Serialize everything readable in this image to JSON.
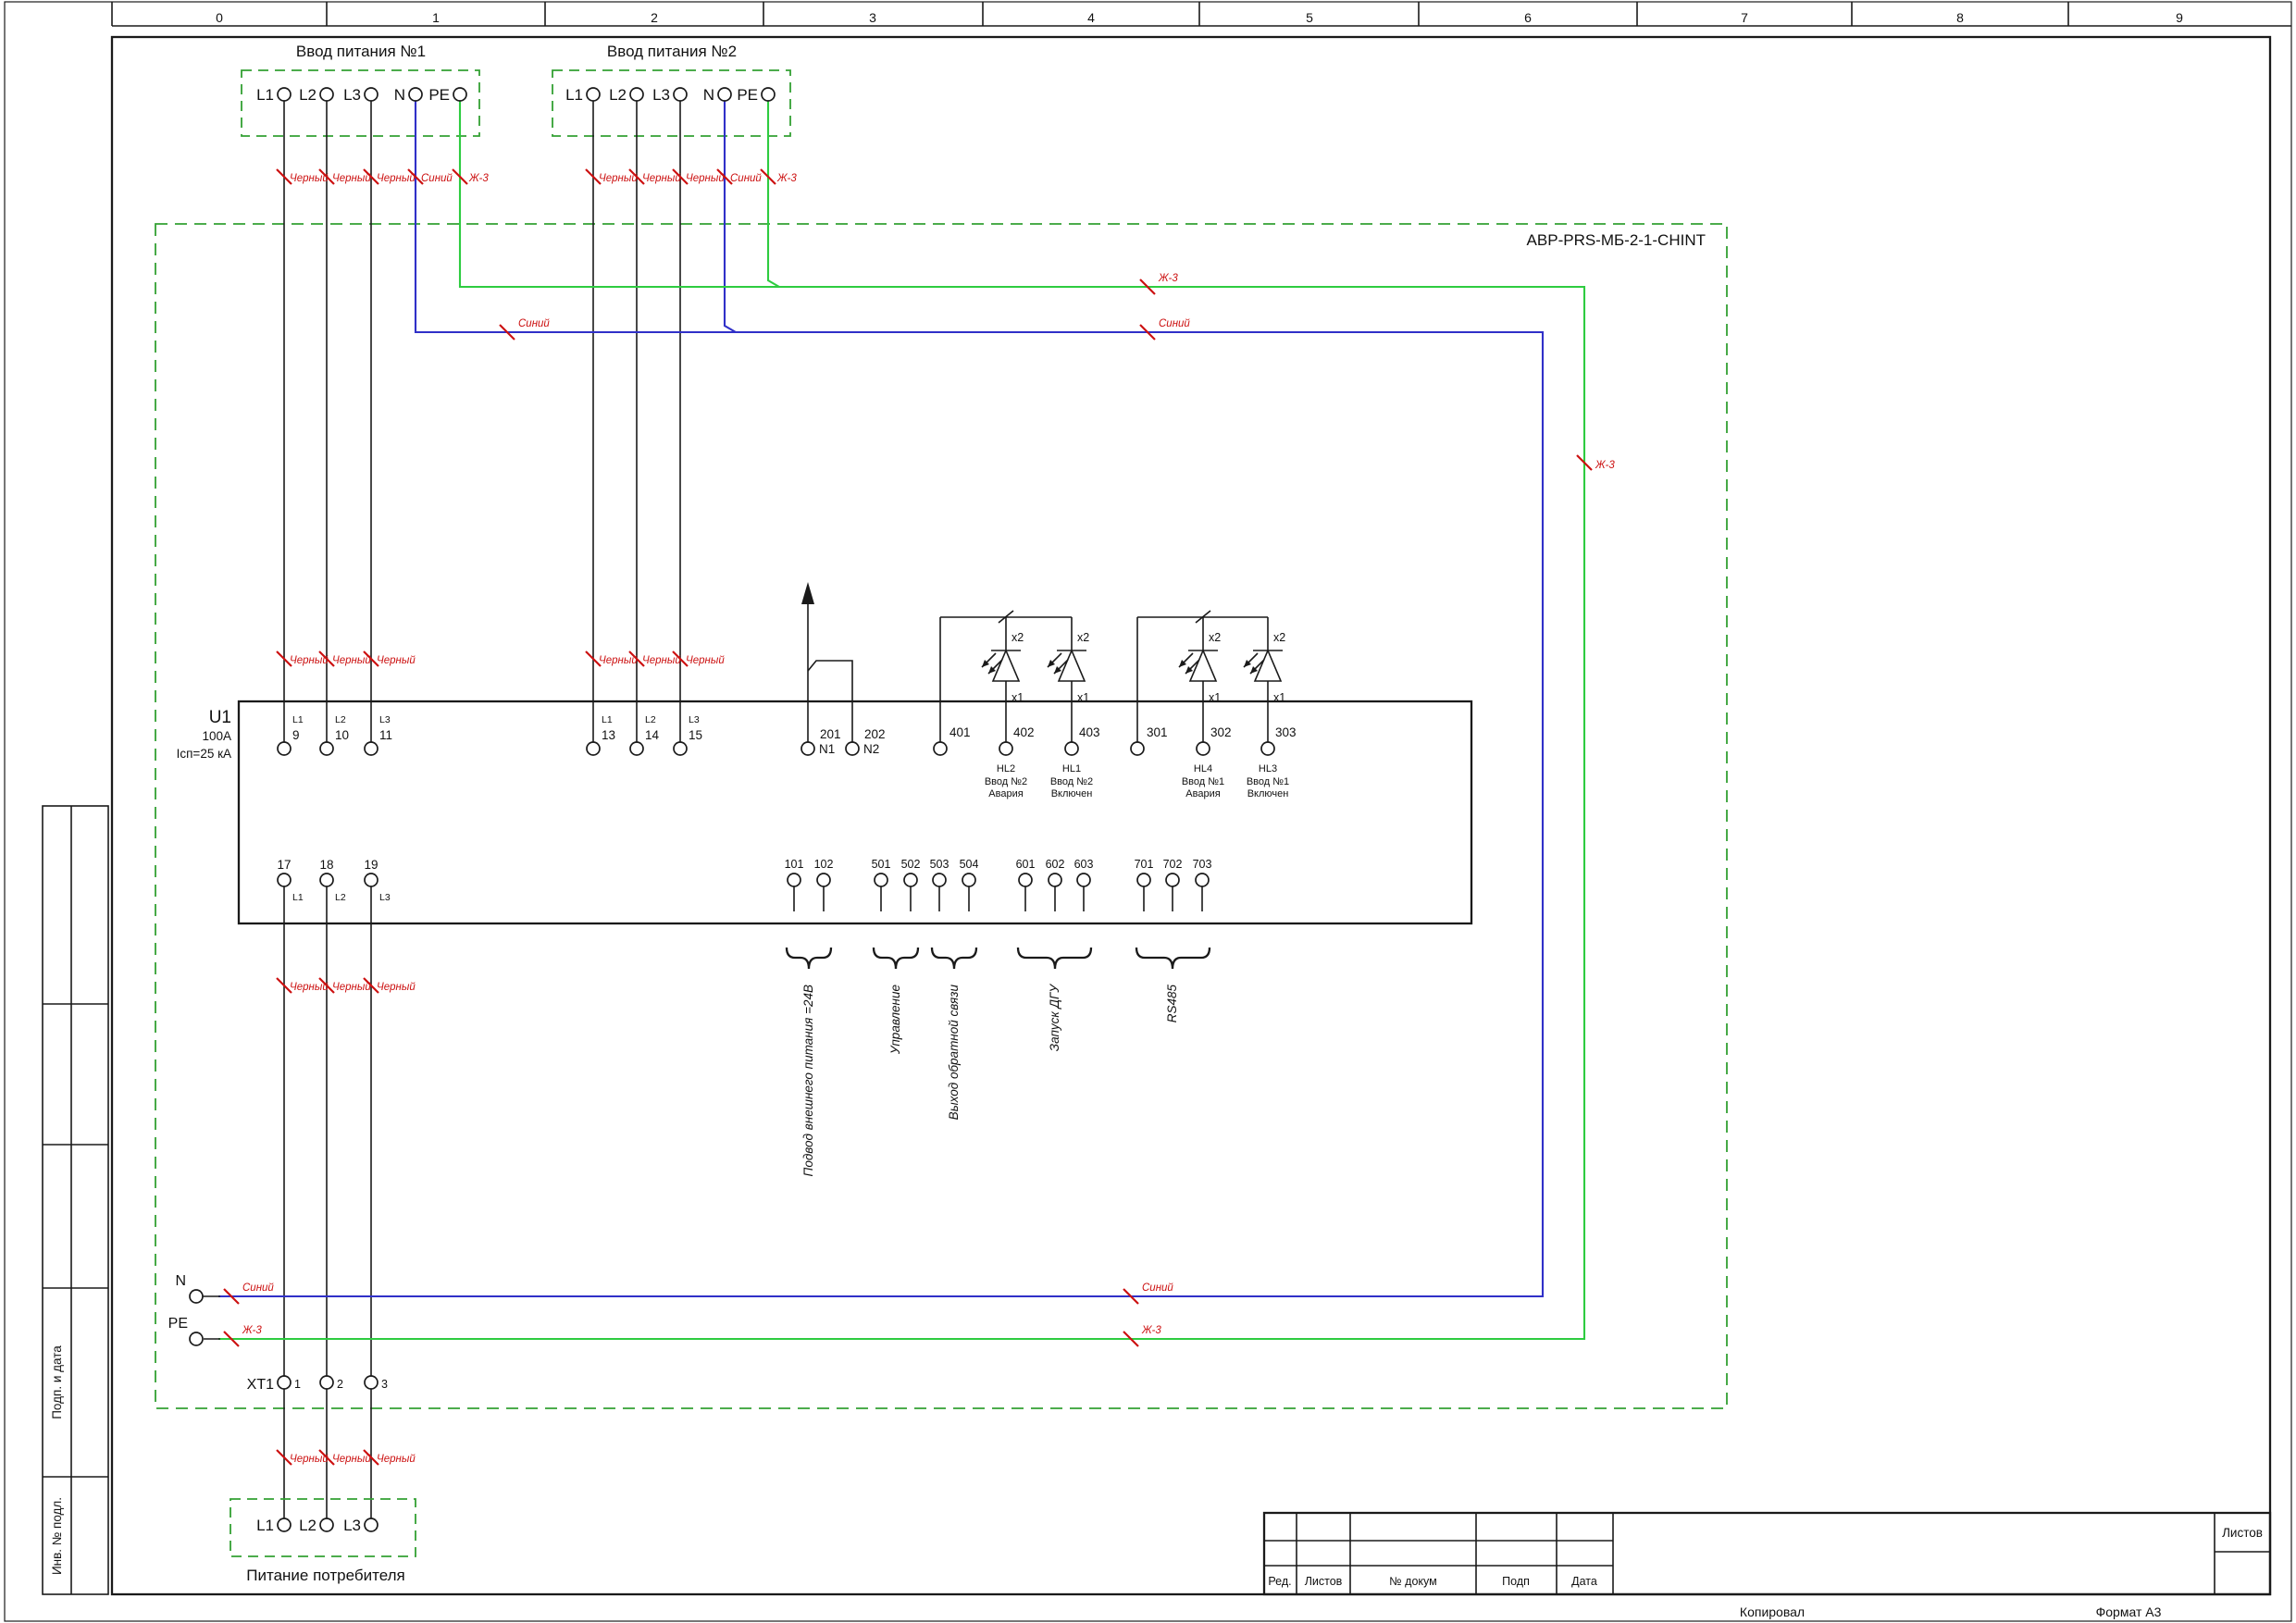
{
  "ruler": [
    "0",
    "1",
    "2",
    "3",
    "4",
    "5",
    "6",
    "7",
    "8",
    "9"
  ],
  "colors": {
    "wire_black": "#1a1a1a",
    "wire_blue": "#3030c8",
    "wire_green": "#2ecc40",
    "dashed_box_green": "#33a033",
    "wire_label_red": "#cc1111"
  },
  "labels": {
    "input1_title": "Ввод питания №1",
    "input2_title": "Ввод питания №2",
    "abp_box": "АВР-PRS-МБ-2-1-CHINT",
    "black_wire": "Черный",
    "blue_wire": "Синий",
    "yg_wire": "Ж-3",
    "n": "N",
    "pe": "PE",
    "xt1": "XT1",
    "consumer_title": "Питание потребителя"
  },
  "input_terminals": [
    "L1",
    "L2",
    "L3",
    "N",
    "PE"
  ],
  "u1": {
    "name": "U1",
    "rating": "100A",
    "breaking": "Icп=25 кА",
    "in1": {
      "labels": [
        "L1",
        "L2",
        "L3"
      ],
      "nums": [
        "9",
        "10",
        "11"
      ]
    },
    "in2": {
      "labels": [
        "L1",
        "L2",
        "L3"
      ],
      "nums": [
        "13",
        "14",
        "15"
      ]
    },
    "neutral": {
      "nums": [
        "201",
        "202"
      ],
      "labels": [
        "N1",
        "N2"
      ]
    },
    "led_in2": {
      "nums": [
        "401",
        "402",
        "403"
      ]
    },
    "led_in1": {
      "nums": [
        "301",
        "302",
        "303"
      ]
    },
    "out": {
      "nums": [
        "17",
        "18",
        "19"
      ],
      "labels": [
        "L1",
        "L2",
        "L3"
      ]
    },
    "aux": {
      "nums": [
        "101",
        "102"
      ]
    },
    "ctrl": {
      "nums": [
        "501",
        "502",
        "503",
        "504"
      ]
    },
    "dgu": {
      "nums": [
        "601",
        "602",
        "603"
      ]
    },
    "rs": {
      "nums": [
        "701",
        "702",
        "703"
      ]
    }
  },
  "led_marks": {
    "top": "x2",
    "bottom": "x1"
  },
  "hl": [
    {
      "name": "HL2",
      "l1": "Ввод №2",
      "l2": "Авария"
    },
    {
      "name": "HL1",
      "l1": "Ввод №2",
      "l2": "Включен"
    },
    {
      "name": "HL4",
      "l1": "Ввод №1",
      "l2": "Авария"
    },
    {
      "name": "HL3",
      "l1": "Ввод №1",
      "l2": "Включен"
    }
  ],
  "groups": [
    "Подвод внешнего питания =24В",
    "Управление",
    "Выход обратной связи",
    "Запуск ДГУ",
    "RS485"
  ],
  "xt_nums": [
    "1",
    "2",
    "3"
  ],
  "consumer_terminals": [
    "L1",
    "L2",
    "L3"
  ],
  "sidebar": [
    "Подп. и дата",
    "Инв. № подл."
  ],
  "titleblock": {
    "cols": [
      "Ред.",
      "Листов",
      "№ докум",
      "Подп",
      "Дата"
    ],
    "sheets": "Листов",
    "copied": "Копировал",
    "format": "Формат А3"
  }
}
